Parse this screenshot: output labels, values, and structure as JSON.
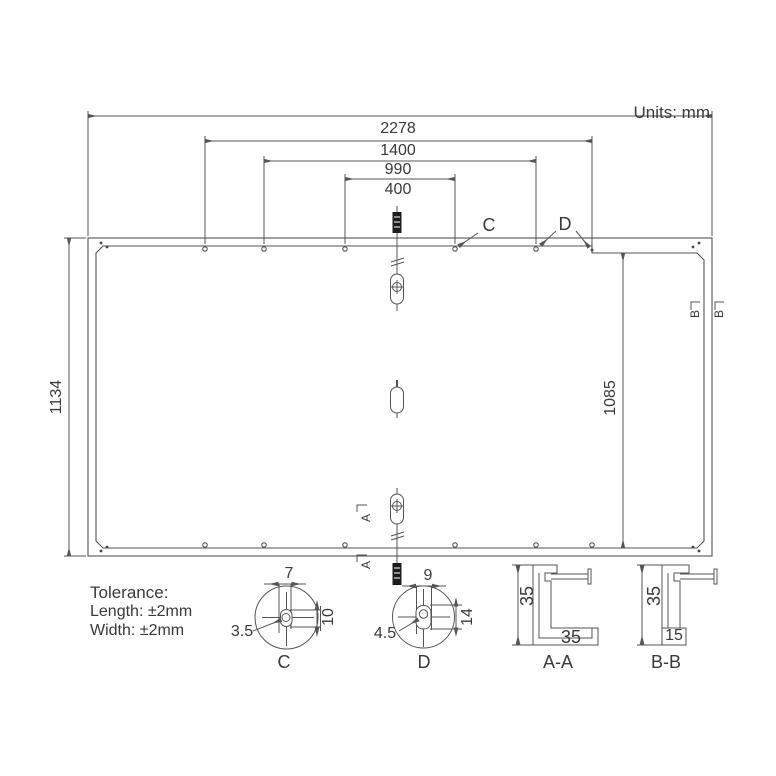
{
  "units_label": "Units: mm",
  "drawing": {
    "width_total": "2278",
    "width_1400": "1400",
    "width_990": "990",
    "width_400": "400",
    "height_total": "1134",
    "height_side": "1085",
    "marker_c": "C",
    "marker_d": "D",
    "marker_a": "A",
    "marker_b": "B"
  },
  "tolerance": {
    "title": "Tolerance:",
    "length": "Length: ±2mm",
    "width": "Width: ±2mm"
  },
  "detail_c": {
    "label": "C",
    "slot_width": "7",
    "slot_height": "10",
    "radius": "3.5"
  },
  "detail_d": {
    "label": "D",
    "slot_width": "9",
    "slot_height": "14",
    "radius": "4.5"
  },
  "section_aa": {
    "label": "A-A",
    "height": "35",
    "width": "35"
  },
  "section_bb": {
    "label": "B-B",
    "height": "35",
    "width": "15"
  },
  "colors": {
    "line": "#555555",
    "text": "#3a3a3a",
    "background": "#ffffff"
  }
}
